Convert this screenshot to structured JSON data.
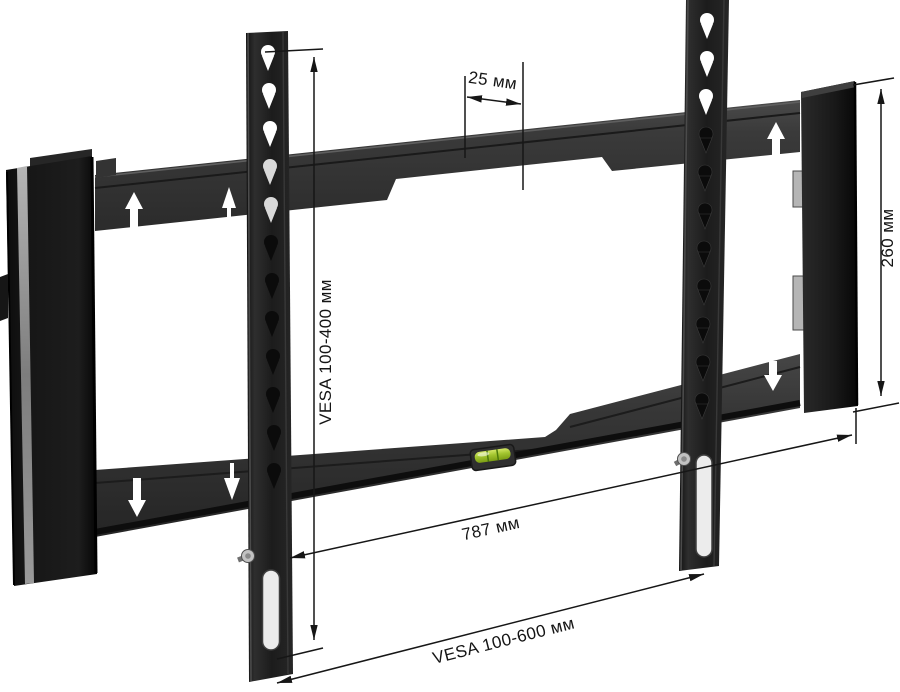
{
  "image": {
    "background": "#ffffff",
    "subject": "wall-mount-bracket-diagram"
  },
  "dimensions": {
    "hole_pitch": {
      "label": "25 мм"
    },
    "vesa_vertical": {
      "label": "VESA 100-400 мм"
    },
    "end_cap_height": {
      "label": "260 мм"
    },
    "plate_width": {
      "label": "787 мм"
    },
    "vesa_horizontal": {
      "label": "VESA 100-600 мм"
    }
  },
  "colors": {
    "plate_metal": "#3a3a3a",
    "strip_metal": "#1e1e1e",
    "end_cap": "#141414",
    "level_green": "#a2c52f",
    "dimension_line": "#161616"
  }
}
